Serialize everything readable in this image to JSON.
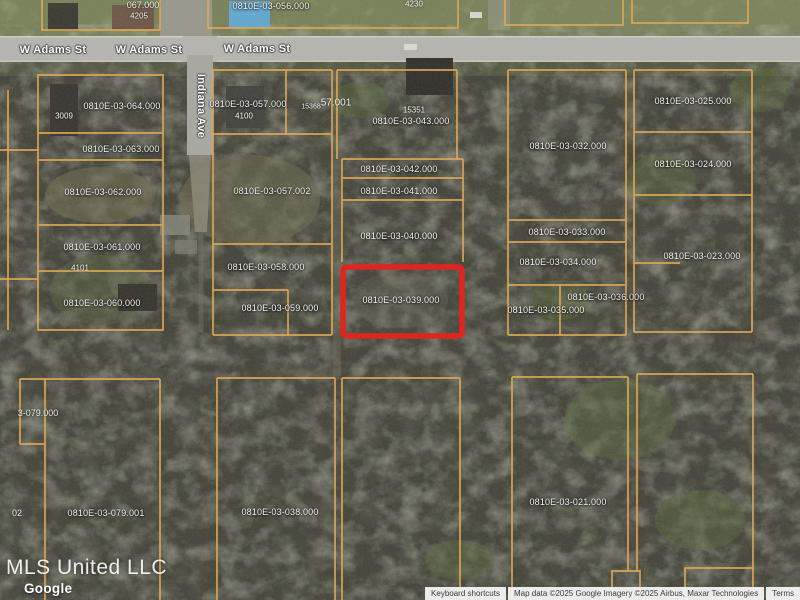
{
  "map": {
    "highlighted_parcel": "0810E-03-039.000",
    "highlight_color": "#e02420",
    "parcel_line_color": "#dfa855",
    "streets": {
      "w_adams_1": "W Adams St",
      "w_adams_2": "W Adams St",
      "w_adams_3": "W Adams St",
      "indiana": "Indiana Ave"
    },
    "parcels": {
      "p056": "0810E-03-056.000",
      "p064": "0810E-03-064.000",
      "p063": "0810E-03-063.000",
      "p062": "0810E-03-062.000",
      "p061": "0810E-03-061.000",
      "p060": "0810E-03-060.000",
      "p057_000": "0810E-03-057.000",
      "p057_002": "0810E-03-057.002",
      "p058": "0810E-03-058.000",
      "p059": "0810E-03-059.000",
      "p043": "0810E-03-043.000",
      "p042": "0810E-03-042.000",
      "p041": "0810E-03-041.000",
      "p040": "0810E-03-040.000",
      "p039": "0810E-03-039.000",
      "p038": "0810E-03-038.000",
      "p032": "0810E-03-032.000",
      "p033": "0810E-03-033.000",
      "p034": "0810E-03-034.000",
      "p035": "0810E-03-035.000",
      "p036": "0810E-03-036.000",
      "p025": "0810E-03-025.000",
      "p024": "0810E-03-024.000",
      "p023": "0810E-03-023.000",
      "p021": "0810E-03-021.000",
      "p079_001": "0810E-03-079.001"
    },
    "fragments": {
      "f067": "067.000",
      "f057_001": "57.001",
      "f079_000": "3-079.000",
      "f02": "02"
    },
    "house_numbers": {
      "h4205": "4205",
      "h4230": "4230",
      "h3009": "3009",
      "h4100": "4100",
      "h4101": "4101",
      "h15351": "15351",
      "h15368": "15368"
    }
  },
  "watermark": {
    "mls": "MLS United LLC",
    "google": "Google"
  },
  "attribution": {
    "keyboard_shortcuts": "Keyboard shortcuts",
    "map_data": "Map data ©2025 Google Imagery ©2025 Airbus, Maxar Technologies",
    "terms": "Terms"
  }
}
